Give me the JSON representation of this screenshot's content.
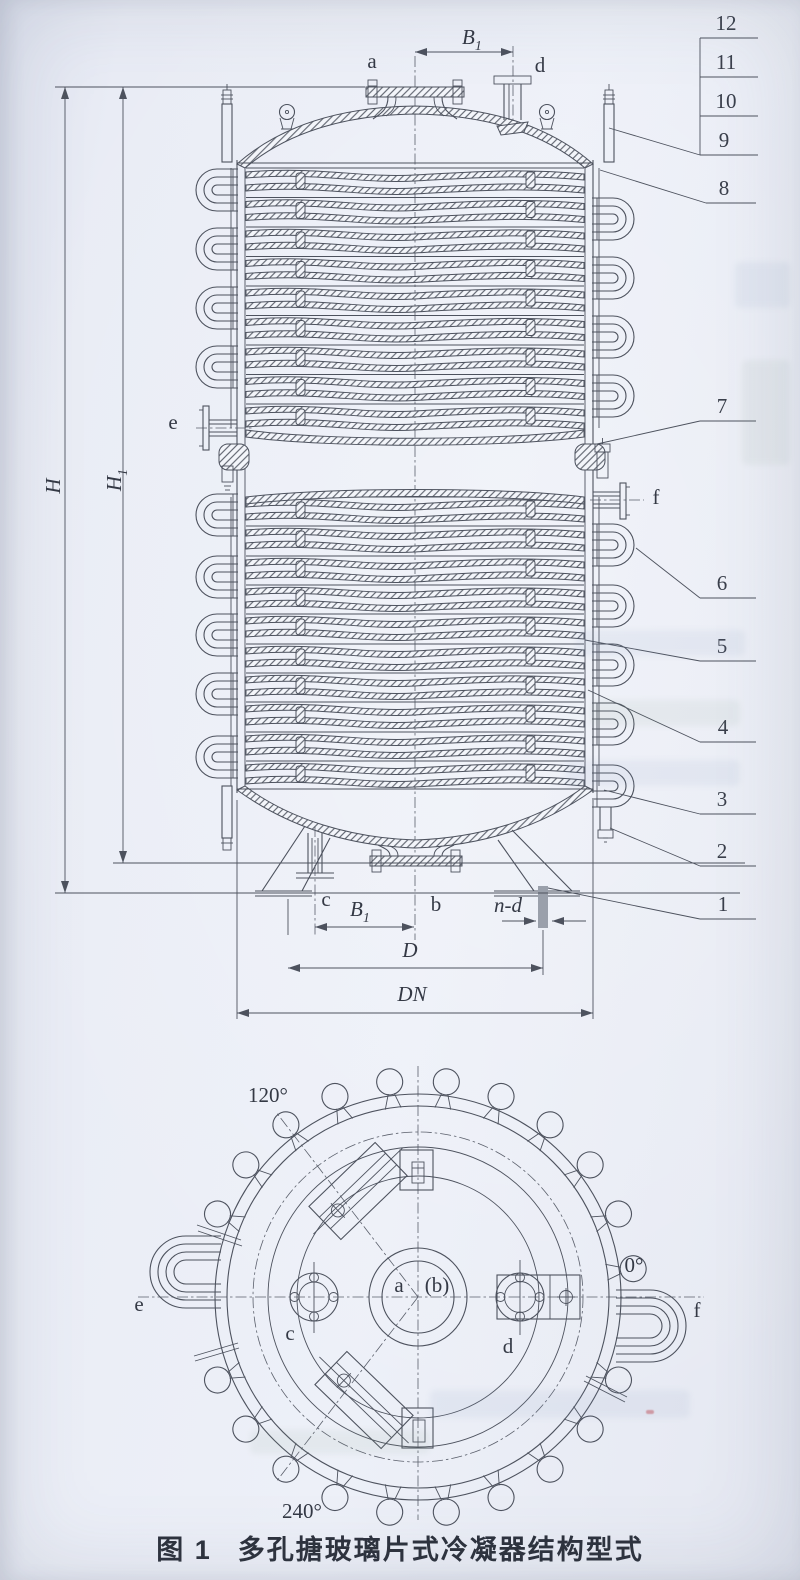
{
  "figure": {
    "caption_prefix": "图 1",
    "caption_title": "多孔搪玻璃片式冷凝器结构型式"
  },
  "callouts": {
    "n1": "1",
    "n2": "2",
    "n3": "3",
    "n4": "4",
    "n5": "5",
    "n6": "6",
    "n7": "7",
    "n8": "8",
    "n9": "9",
    "n10": "10",
    "n11": "11",
    "n12": "12"
  },
  "letters": {
    "a": "a",
    "b": "b",
    "c": "c",
    "d": "d",
    "e": "e",
    "f": "f"
  },
  "dims": {
    "H": "H",
    "H1_base": "H",
    "H1_sub": "1",
    "B1_base": "B",
    "B1_sub": "1",
    "D": "D",
    "DN": "DN",
    "n_d": "n-d"
  },
  "plan": {
    "deg0": "0°",
    "deg120": "120°",
    "deg240": "240°",
    "center_a": "a",
    "center_b": "(b)"
  },
  "colors": {
    "paper": "#e9ecf5",
    "line": "#4d525e",
    "ink": "#343945"
  }
}
